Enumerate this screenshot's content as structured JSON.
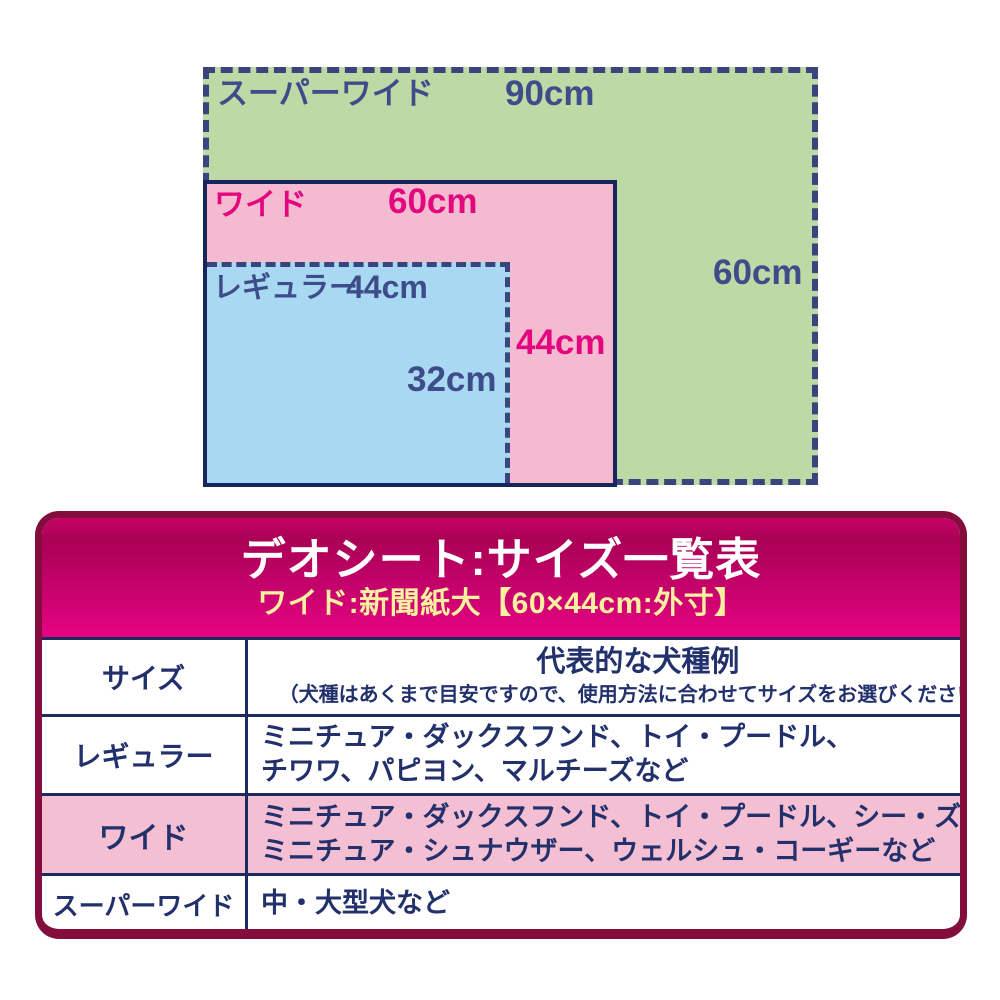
{
  "diagram": {
    "sizes": [
      {
        "id": "super-wide",
        "label": "スーパーワイド",
        "width_label": "90cm",
        "height_label": "60cm",
        "fill": "#bed9a6"
      },
      {
        "id": "wide",
        "label": "ワイド",
        "width_label": "60cm",
        "height_label": "44cm",
        "fill": "#f4bbd0"
      },
      {
        "id": "regular",
        "label": "レギュラー",
        "width_label": "44cm",
        "height_label": "32cm",
        "fill": "#a8d8f2"
      }
    ],
    "colors": {
      "navy_border": "#39457c",
      "navy_text": "#3e4d89",
      "magenta_text": "#e3067e",
      "wide_border": "#16255c"
    }
  },
  "panel": {
    "title": "デオシート:サイズ一覧表",
    "subtitle": "ワイド:新聞紙大【60×44cm:外寸】",
    "colors": {
      "header_gradient_top": "#c70367",
      "header_gradient_mid": "#a90254",
      "header_gradient_bottom": "#e50382",
      "frame_maroon": "#830d3d",
      "title_text": "#ffffff",
      "subtitle_text": "#f9f0a0",
      "table_text": "#22306b",
      "table_border": "#1c2a5e",
      "highlight_row": "#f5bfd3"
    },
    "table": {
      "header": {
        "col1": "サイズ",
        "col2_title": "代表的な犬種例",
        "col2_note": "（犬種はあくまで目安ですので、使用方法に合わせてサイズをお選びください）"
      },
      "rows": [
        {
          "size": "レギュラー",
          "line1": "ミニチュア・ダックスフンド、トイ・プードル、",
          "line2": "チワワ、パピヨン、マルチーズなど",
          "highlight": false
        },
        {
          "size": "ワイド",
          "line1": "ミニチュア・ダックスフンド、トイ・プードル、シー・ズー、",
          "line2": "ミニチュア・シュナウザー、ウェルシュ・コーギーなど",
          "highlight": true
        },
        {
          "size": "スーパーワイド",
          "line1": "中・大型犬など",
          "line2": "",
          "highlight": false
        }
      ]
    }
  }
}
